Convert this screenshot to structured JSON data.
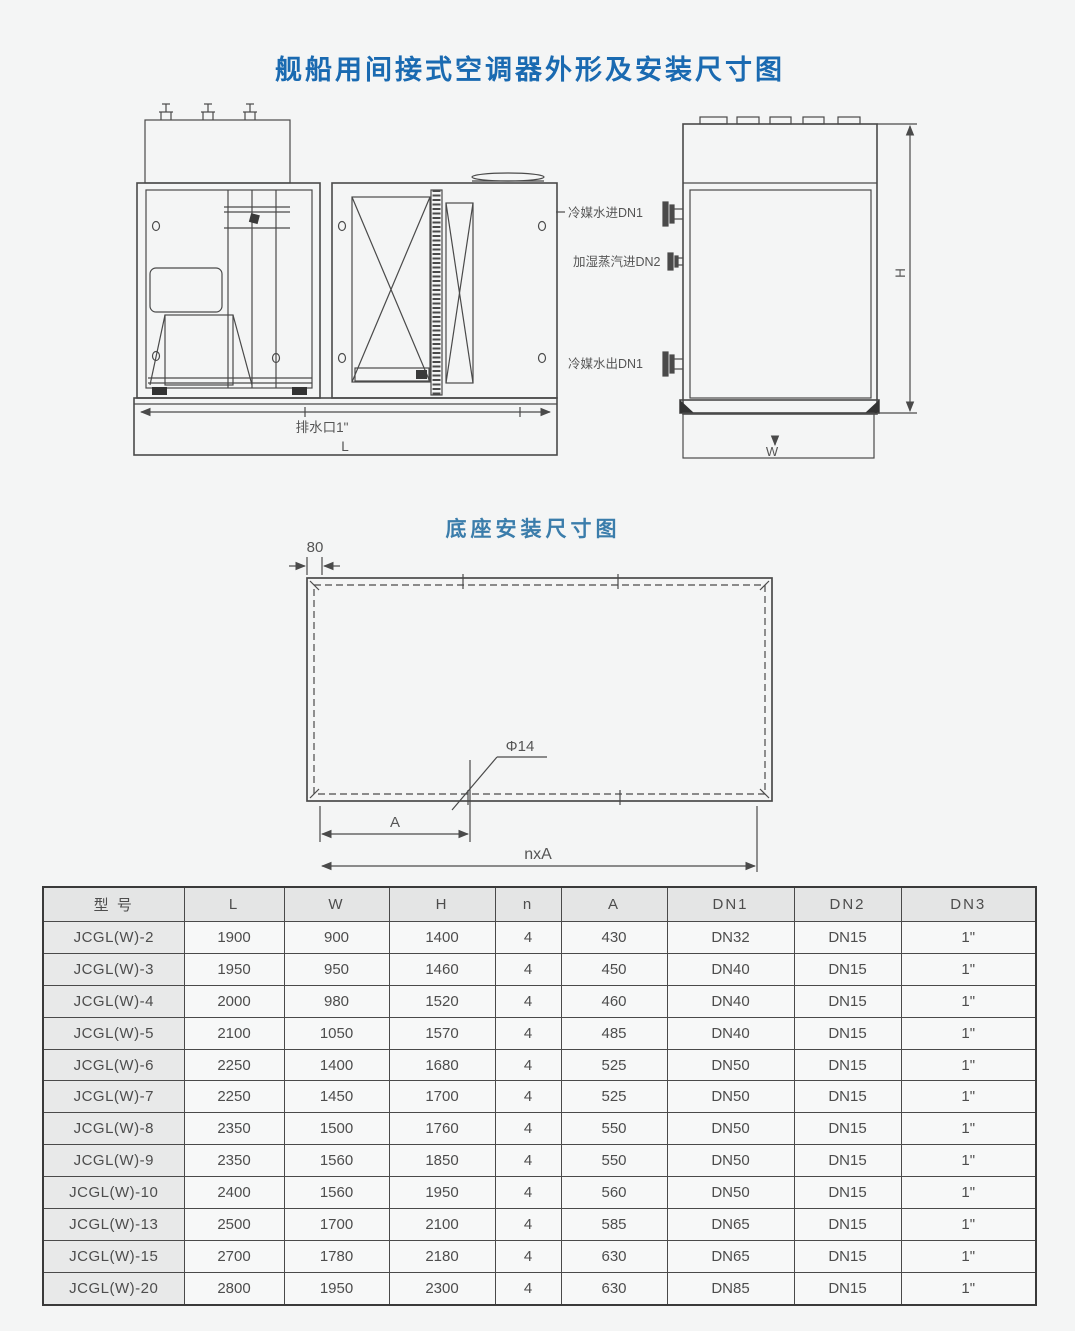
{
  "page": {
    "title": "舰船用间接式空调器外形及安装尺寸图",
    "base_drawing_title": "底座安装尺寸图"
  },
  "outline_drawing": {
    "port_labels": {
      "chilled_water_in": "冷媒水进DN1",
      "steam_in": "加湿蒸汽进DN2",
      "chilled_water_out": "冷媒水出DN1"
    },
    "drain_label": "排水口1\"",
    "dim_L": "L",
    "dim_H": "H",
    "dim_W": "W"
  },
  "base_drawing": {
    "dim_80": "80",
    "hole_label": "Φ14",
    "dim_A": "A",
    "dim_nxA": "nxA"
  },
  "colors": {
    "title_blue": "#1a6ab1",
    "subtitle_blue": "#3b7dab",
    "line_gray": "#4a4a4a"
  },
  "table": {
    "headers": [
      "型 号",
      "L",
      "W",
      "H",
      "n",
      "A",
      "DN1",
      "DN2",
      "DN3"
    ],
    "rows": [
      [
        "JCGL(W)-2",
        "1900",
        "900",
        "1400",
        "4",
        "430",
        "DN32",
        "DN15",
        "1\""
      ],
      [
        "JCGL(W)-3",
        "1950",
        "950",
        "1460",
        "4",
        "450",
        "DN40",
        "DN15",
        "1\""
      ],
      [
        "JCGL(W)-4",
        "2000",
        "980",
        "1520",
        "4",
        "460",
        "DN40",
        "DN15",
        "1\""
      ],
      [
        "JCGL(W)-5",
        "2100",
        "1050",
        "1570",
        "4",
        "485",
        "DN40",
        "DN15",
        "1\""
      ],
      [
        "JCGL(W)-6",
        "2250",
        "1400",
        "1680",
        "4",
        "525",
        "DN50",
        "DN15",
        "1\""
      ],
      [
        "JCGL(W)-7",
        "2250",
        "1450",
        "1700",
        "4",
        "525",
        "DN50",
        "DN15",
        "1\""
      ],
      [
        "JCGL(W)-8",
        "2350",
        "1500",
        "1760",
        "4",
        "550",
        "DN50",
        "DN15",
        "1\""
      ],
      [
        "JCGL(W)-9",
        "2350",
        "1560",
        "1850",
        "4",
        "550",
        "DN50",
        "DN15",
        "1\""
      ],
      [
        "JCGL(W)-10",
        "2400",
        "1560",
        "1950",
        "4",
        "560",
        "DN50",
        "DN15",
        "1\""
      ],
      [
        "JCGL(W)-13",
        "2500",
        "1700",
        "2100",
        "4",
        "585",
        "DN65",
        "DN15",
        "1\""
      ],
      [
        "JCGL(W)-15",
        "2700",
        "1780",
        "2180",
        "4",
        "630",
        "DN65",
        "DN15",
        "1\""
      ],
      [
        "JCGL(W)-20",
        "2800",
        "1950",
        "2300",
        "4",
        "630",
        "DN85",
        "DN15",
        "1\""
      ]
    ]
  }
}
